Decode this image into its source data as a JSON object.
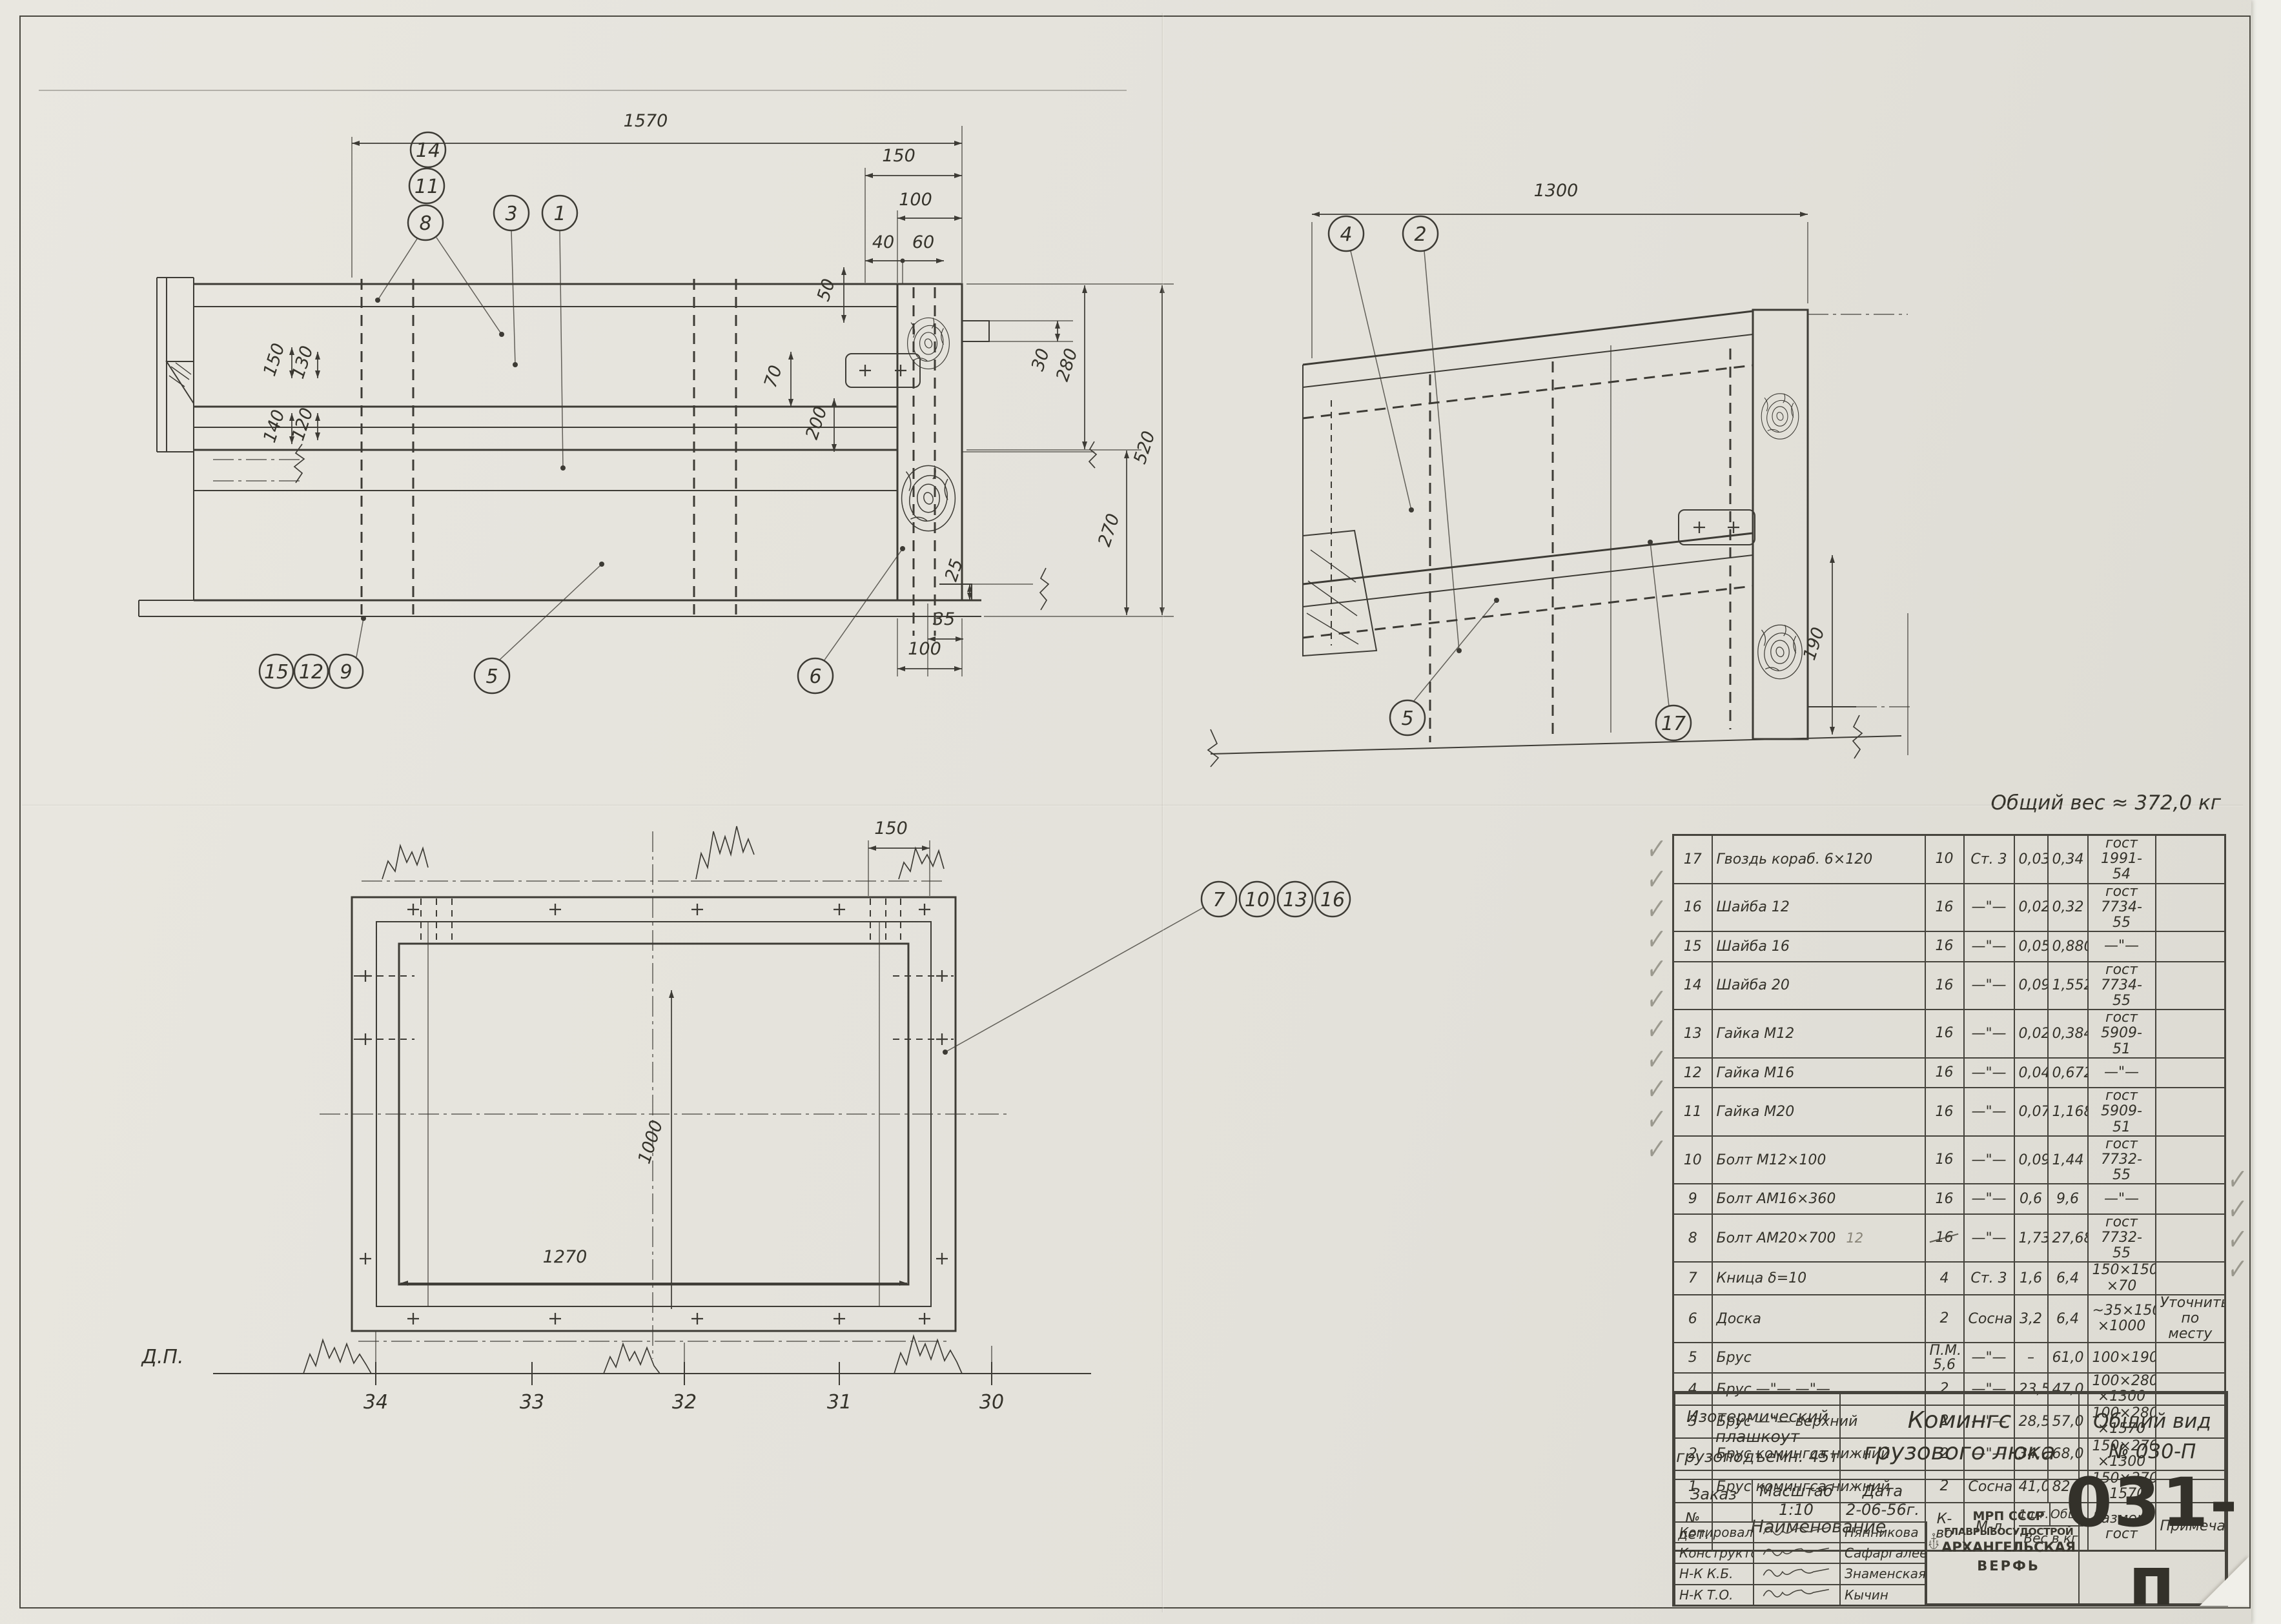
{
  "colors": {
    "paper": "#e5e3dc",
    "ink": "#3d3b35",
    "pencil": "#8d8a7e"
  },
  "notes": {
    "total_weight": "Общий вес ≈ 372,0 кг"
  },
  "views": {
    "front": {
      "callouts": {
        "c14": "14",
        "c11": "11",
        "c8": "8",
        "c3": "3",
        "c1": "1",
        "c15": "15",
        "c12": "12",
        "c9": "9",
        "c5": "5",
        "c6": "6"
      },
      "dims": {
        "len": "1570",
        "w150": "150",
        "w100": "100",
        "w40": "40",
        "w60": "60",
        "t50": "50",
        "h70": "70",
        "h200": "200",
        "h280": "280",
        "h270": "270",
        "h520": "520",
        "h30": "30",
        "h25": "25",
        "w35": "35",
        "w100b": "100",
        "l150": "150",
        "l130": "130",
        "l140": "140",
        "l120": "120"
      }
    },
    "side": {
      "callouts": {
        "c4": "4",
        "c2": "2",
        "c5": "5",
        "c17": "17"
      },
      "dims": {
        "len": "1300",
        "h190": "190"
      }
    },
    "plan": {
      "callouts": {
        "c7": "7",
        "c10": "10",
        "c13": "13",
        "c16": "16"
      },
      "dims": {
        "w150": "150",
        "h1000": "1000",
        "w1270": "1270"
      },
      "baseline": "Д.П.",
      "stations": [
        "34",
        "33",
        "32",
        "31",
        "30"
      ]
    }
  },
  "bom": {
    "header": {
      "no": "№\nдет.",
      "name": "Наименование",
      "qty": "К-во",
      "mat": "М-л",
      "w1": "1шт.",
      "wt": "Общ.",
      "w_label": "Вес в кг",
      "size": "Размер,\nгост",
      "note": "Примечан."
    },
    "rows": [
      {
        "no": "17",
        "name": "Гвоздь кораб. 6×120",
        "qty": "10",
        "mat": "Ст. 3",
        "w1": "0,034",
        "wt": "0,34",
        "size": "гост\n1991-54",
        "note": "",
        "check_left": true,
        "check_right": false
      },
      {
        "no": "16",
        "name": "Шайба 12",
        "qty": "16",
        "mat": "—\"—",
        "w1": "0,02",
        "wt": "0,32",
        "size": "гост\n7734-55",
        "note": "",
        "check_left": true,
        "check_right": false
      },
      {
        "no": "15",
        "name": "Шайба 16",
        "qty": "16",
        "mat": "—\"—",
        "w1": "0,055",
        "wt": "0,880",
        "size": "—\"—",
        "note": "",
        "check_left": true,
        "check_right": false
      },
      {
        "no": "14",
        "name": "Шайба 20",
        "qty": "16",
        "mat": "—\"—",
        "w1": "0,097",
        "wt": "1,552",
        "size": "гост\n7734-55",
        "note": "",
        "check_left": true,
        "check_right": false
      },
      {
        "no": "13",
        "name": "Гайка М12",
        "qty": "16",
        "mat": "—\"—",
        "w1": "0,024",
        "wt": "0,384",
        "size": "гост\n5909-51",
        "note": "",
        "check_left": true,
        "check_right": false
      },
      {
        "no": "12",
        "name": "Гайка М16",
        "qty": "16",
        "mat": "—\"—",
        "w1": "0,042",
        "wt": "0,672",
        "size": "—\"—",
        "note": "",
        "check_left": true,
        "check_right": false
      },
      {
        "no": "11",
        "name": "Гайка М20",
        "qty": "16",
        "mat": "—\"—",
        "w1": "0,073",
        "wt": "1,168",
        "size": "гост\n5909-51",
        "note": "",
        "check_left": true,
        "check_right": false
      },
      {
        "no": "10",
        "name": "Болт М12×100",
        "qty": "16",
        "mat": "—\"—",
        "w1": "0,09",
        "wt": "1,44",
        "size": "гост\n7732-55",
        "note": "",
        "check_left": true,
        "check_right": false
      },
      {
        "no": "9",
        "name": "Болт АМ16×360",
        "qty": "16",
        "mat": "—\"—",
        "w1": "0,6",
        "wt": "9,6",
        "size": "—\"—",
        "note": "",
        "check_left": true,
        "check_right": false
      },
      {
        "no": "8",
        "name": "Болт АМ20×700",
        "pencil": "12",
        "qty": "16",
        "qty_struck": true,
        "mat": "—\"—",
        "w1": "1,73",
        "wt": "27,68",
        "size": "гост\n7732-55",
        "note": "",
        "check_left": true,
        "check_right": false
      },
      {
        "no": "7",
        "name": "Кница δ=10",
        "qty": "4",
        "mat": "Ст. 3",
        "w1": "1,6",
        "wt": "6,4",
        "size": "150×150\n×70",
        "note": "",
        "check_left": true,
        "check_right": false
      },
      {
        "no": "6",
        "name": "Доска",
        "qty": "2",
        "mat": "Сосна",
        "w1": "3,2",
        "wt": "6,4",
        "size": "~35×150\n×1000",
        "note": "Уточнить\nпо месту",
        "check_left": false,
        "check_right": true
      },
      {
        "no": "5",
        "name": "Брус",
        "qty": "П.М.\n5,6",
        "mat": "—\"—",
        "w1": "–",
        "wt": "61,0",
        "size": "100×190",
        "note": "",
        "check_left": false,
        "check_right": true
      },
      {
        "no": "4",
        "name": "Брус —\"— —\"—",
        "qty": "2",
        "mat": "—\"—",
        "w1": "23,5",
        "wt": "47,0",
        "size": "100×280\n×1300",
        "note": "",
        "check_left": false,
        "check_right": true
      },
      {
        "no": "3",
        "name": "Брус —\"— верхний",
        "qty": "2",
        "mat": "—\"—",
        "w1": "28,5",
        "wt": "57,0",
        "size": "100×280\n×1570",
        "note": "",
        "check_left": false,
        "check_right": true
      },
      {
        "no": "2",
        "name": "Брус комингса нижний",
        "qty": "2",
        "mat": "—\"—",
        "w1": "34,0",
        "wt": "68,0",
        "size": "150×270\n×1300",
        "note": "",
        "check_left": false,
        "check_right": false
      },
      {
        "no": "1",
        "name": "Брус комингса нижний",
        "qty": "2",
        "mat": "Сосна",
        "w1": "41,0",
        "wt": "82,0",
        "size": "150×270\n×1570",
        "note": "",
        "check_left": false,
        "check_right": false
      }
    ]
  },
  "title_block": {
    "object": "Изотермический\nплашкоут\nгрузоподъемн. 45т",
    "title": "Комингс\nгрузового люка",
    "view_label": "Общий вид\n№ 030-П",
    "order_label": "Заказ",
    "scale": "Масштаб\n1:10",
    "date": "Дата\n2-06-56г.",
    "org": {
      "l1": "МРП СССР",
      "l2": "ГЛАВРЫБОСУДОСТРОЙ",
      "l3": "АРХАНГЕЛЬСКАЯ",
      "l4": "ВЕРФЬ"
    },
    "logo": {
      "a": "А",
      "s": "С",
      "v": "В"
    },
    "doc_number": "031-п",
    "signatures": [
      {
        "role": "Копировала",
        "name": "Нянникова"
      },
      {
        "role": "Конструктор",
        "name": "Сафаргалеева"
      },
      {
        "role": "Н-К К.Б.",
        "name": "Знаменская"
      },
      {
        "role": "Н-К Т.О.",
        "name": "Кычин"
      }
    ]
  }
}
